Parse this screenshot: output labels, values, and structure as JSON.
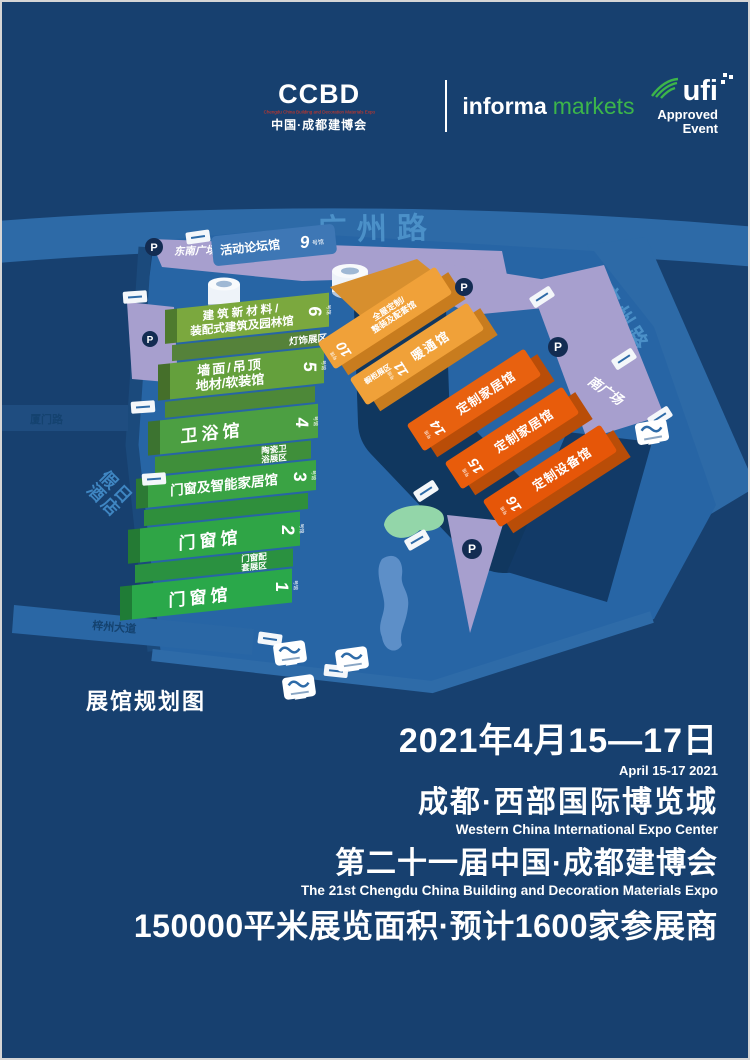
{
  "header": {
    "ccbd": {
      "logo": "CCBD",
      "tagline_en": "Chengdu China Building and Decoration Materials Expo",
      "name_cn": "中国·成都建博会"
    },
    "informa": {
      "word1": "informa",
      "word2": "markets"
    },
    "ufi": {
      "name": "ufi",
      "line1": "Approved",
      "line2": "Event"
    }
  },
  "map": {
    "caption": "展馆规划图",
    "parking_label": "P",
    "roads": {
      "top": "广州路",
      "east": "广州路",
      "west": "厦门路",
      "southwest": "梓州大道"
    },
    "places": {
      "hotel_line1": "假日",
      "hotel_line2": "酒店",
      "se_plaza": "东南广场",
      "south_plaza": "南广场"
    },
    "forum_hall": {
      "name": "活动论坛馆",
      "num": "9",
      "suffix": "号馆"
    },
    "green_halls": [
      {
        "num": "6",
        "suffix": "号馆",
        "line1": "建筑新材料/",
        "line2": "装配式建筑及园林馆"
      },
      {
        "num": "5",
        "suffix": "号馆",
        "line1": "墙面/吊顶",
        "line2": "地材/软装馆"
      },
      {
        "num": "4",
        "suffix": "号馆",
        "line1": "卫浴馆",
        "line2": ""
      },
      {
        "num": "3",
        "suffix": "号馆",
        "line1": "门窗及智能家居馆",
        "line2": ""
      },
      {
        "num": "2",
        "suffix": "号馆",
        "line1": "门窗馆",
        "line2": ""
      },
      {
        "num": "1",
        "suffix": "号馆",
        "line1": "门窗馆",
        "line2": ""
      }
    ],
    "green_subzones": [
      {
        "line1": "灯饰展区",
        "line2": ""
      },
      {
        "line1": "陶瓷卫",
        "line2": "浴展区"
      },
      {
        "line1": "门窗配",
        "line2": "套展区"
      }
    ],
    "orange_halls": [
      {
        "num": "10",
        "suffix": "号馆",
        "line1": "全屋定制/",
        "line2": "整装及配套馆"
      },
      {
        "num": "11",
        "suffix": "号馆",
        "line1": "暖通馆",
        "line2": ""
      },
      {
        "num": "14",
        "suffix": "号馆",
        "line1": "定制家居馆",
        "line2": ""
      },
      {
        "num": "15",
        "suffix": "号馆",
        "line1": "定制家居馆",
        "line2": ""
      },
      {
        "num": "16",
        "suffix": "号馆",
        "line1": "定制设备馆",
        "line2": ""
      }
    ],
    "orange_subzone": "橱柜展区"
  },
  "footer": {
    "date_cn": "2021年4月15—17日",
    "date_en": "April 15-17 2021",
    "venue_cn": "成都·西部国际博览城",
    "venue_en": "Western China International Expo Center",
    "title_cn": "第二十一届中国·成都建博会",
    "title_en": "The 21st Chengdu China Building and Decoration Materials Expo",
    "stats": "150000平米展览面积·预计1600家参展商"
  },
  "colors": {
    "background": "#17406F",
    "map_ground": "#2765A5",
    "green_hall": "#2FA546",
    "olive_hall": "#7BA83E",
    "light_orange_hall": "#F0A139",
    "dark_orange_hall": "#E8610F",
    "plaza_purple": "#A79FCE",
    "road_text_blue": "#4B90C8",
    "informa_green": "#3CB54A",
    "ccbd_red": "#E8341C"
  }
}
